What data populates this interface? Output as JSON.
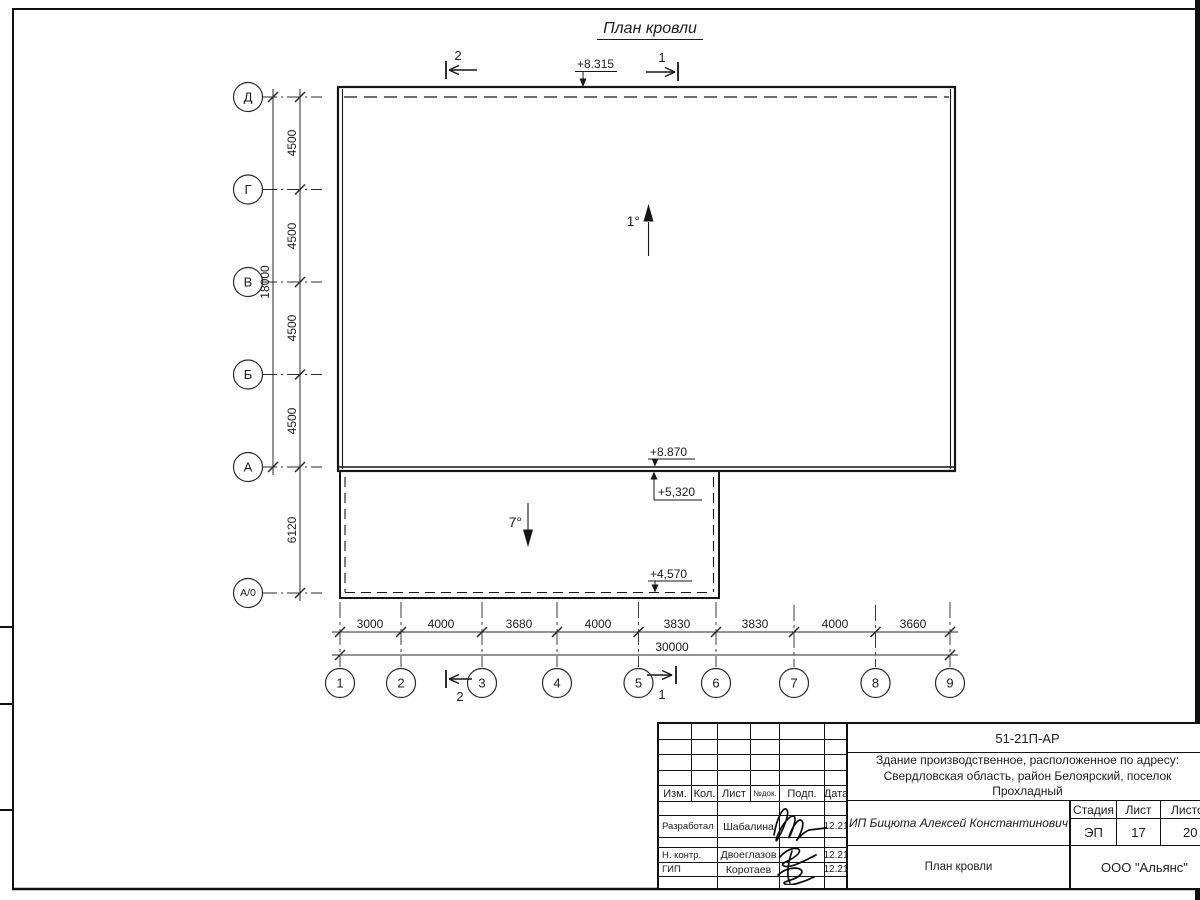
{
  "title": "План кровли",
  "axes": {
    "rows": [
      "Д",
      "Г",
      "В",
      "Б",
      "А",
      "А/0"
    ],
    "cols": [
      "1",
      "2",
      "3",
      "4",
      "5",
      "6",
      "7",
      "8",
      "9"
    ]
  },
  "dims": {
    "row_segments": [
      "4500",
      "4500",
      "4500",
      "4500"
    ],
    "row_total": "18000",
    "annex_height": "6120",
    "col_segments": [
      "3000",
      "4000",
      "3680",
      "4000",
      "3830",
      "3830",
      "4000",
      "3660"
    ],
    "col_total": "30000"
  },
  "elevations": {
    "main_roof": "+8.315",
    "parapet": "+8.870",
    "annex_top": "+5,320",
    "annex_eave": "+4,570"
  },
  "slopes": {
    "main": "1°",
    "annex": "7°"
  },
  "sections": {
    "one": "1",
    "two": "2"
  },
  "titleblock": {
    "doc_code": "51-21П-АР",
    "description": "Здание производственное, расположенное по адресу: Свердловская область, район Белоярский, поселок Прохладный",
    "columns": {
      "izm": "Изм.",
      "kol": "Кол.",
      "list": "Лист",
      "ndok": "№док.",
      "podp": "Подп.",
      "data": "Дата"
    },
    "developer": {
      "role": "Разработал",
      "name": "Шабалина",
      "date": "12.21"
    },
    "ncontrol": {
      "role": "Н. контр.",
      "name": "Двоеглазов",
      "date": "12.21"
    },
    "gip": {
      "role": "ГИП",
      "name": "Коротаев",
      "date": "12.21"
    },
    "client": "ИП Бицюта Алексей Константинович",
    "stage": {
      "label": "Стадия",
      "value": "ЭП"
    },
    "sheet": {
      "label": "Лист",
      "value": "17"
    },
    "sheets": {
      "label": "Листов",
      "value": "20"
    },
    "sheet_title": "План кровли",
    "company": "ООО \"Альянс\""
  },
  "colors": {
    "line": "#1c1c1c",
    "background": "#ffffff"
  }
}
